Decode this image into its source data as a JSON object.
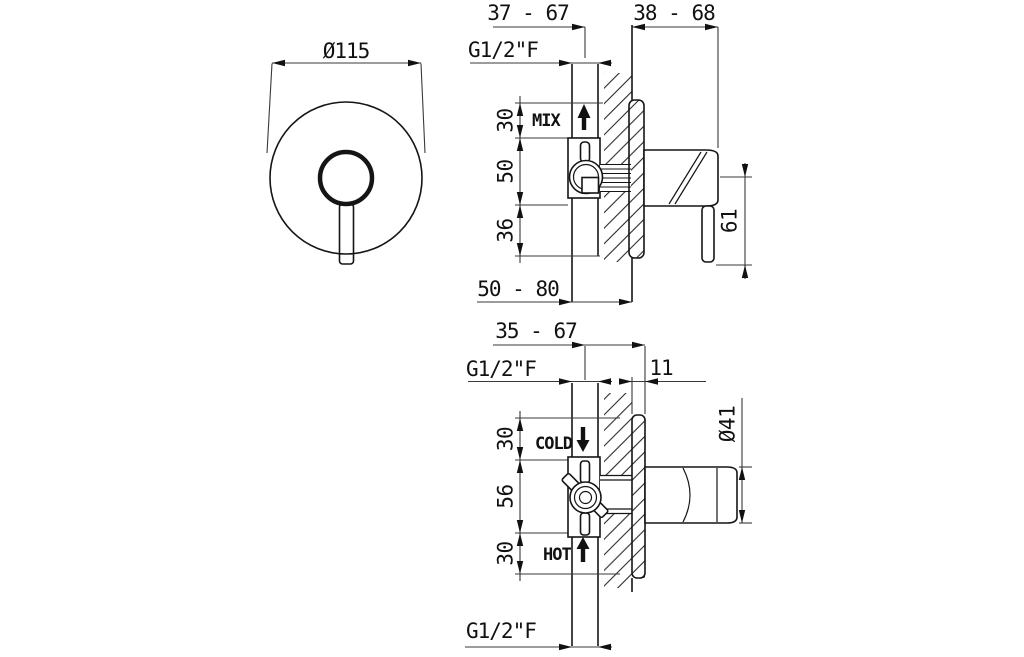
{
  "colors": {
    "background": "#ffffff",
    "object_line": "#151515",
    "dim_line": "#3a3a3a",
    "text": "#111111"
  },
  "front_view": {
    "plate_diameter": "Ø115"
  },
  "mixer_view": {
    "depth_range": "37 - 67",
    "handle_projection_range": "38 - 68",
    "inlet_thread": "G1/2\"F",
    "flow_label": "MIX",
    "offset_top": "30",
    "offset_center": "50",
    "offset_bottom": "36",
    "pipe_depth_range": "50 - 80",
    "lever_length": "61"
  },
  "diverter_view": {
    "depth_range": "35 - 67",
    "inlet_thread": "G1/2\"F",
    "plate_thickness": "11",
    "cold_label": "COLD",
    "hot_label": "HOT",
    "offset_top": "30",
    "offset_center": "56",
    "offset_bottom": "30",
    "knob_diameter": "Ø41",
    "outlet_thread": "G1/2\"F"
  }
}
